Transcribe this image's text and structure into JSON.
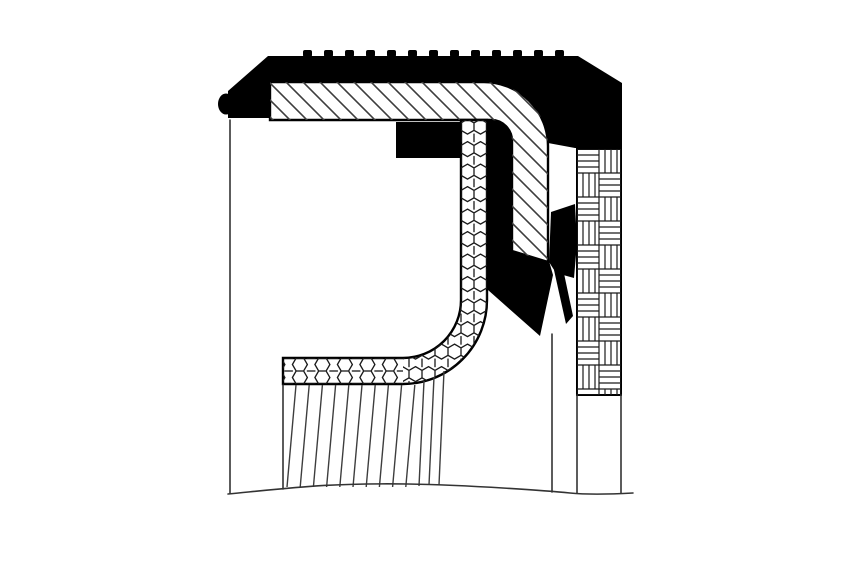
{
  "diagram": {
    "title": "Radial shaft seal cross-section diagram",
    "type": "technical line drawing",
    "parts": [
      {
        "name": "outer-case-cap",
        "rendering": "solid black, serrated top edge, beveled corners"
      },
      {
        "name": "metal-insert-band",
        "rendering": "diagonal line hatching, L-shaped band"
      },
      {
        "name": "spring-cavity-band",
        "rendering": "honeycomb hatching, J-shaped band"
      },
      {
        "name": "elastomer-lip",
        "rendering": "solid black with two downward lip points"
      },
      {
        "name": "press-fit-surface-column",
        "rendering": "basket-weave hatching"
      },
      {
        "name": "seal-body",
        "rendering": "white with thin contour outline"
      },
      {
        "name": "lip-contact-fan",
        "rendering": "fanned near-vertical hatching"
      },
      {
        "name": "shaft-break-line",
        "rendering": "wavy bottom cut line"
      }
    ]
  },
  "colors": {
    "background": "#ffffff",
    "ink": "#000000",
    "hatch": "#3d3d3d",
    "outline": "#333333",
    "fine": "#1a1a1a"
  },
  "serration": {
    "count": 13,
    "start_x": 303,
    "spacing": 21,
    "tooth_width": 9,
    "tooth_height": 7,
    "top_y": 50
  },
  "fan": {
    "count": 10,
    "start_x": 296,
    "spacing": 13.2,
    "lean": 9,
    "top_y": 385,
    "bottom_y": 487,
    "extra_lines": [
      [
        424,
        381,
        419,
        486
      ],
      [
        434,
        377,
        429,
        485
      ],
      [
        444,
        371,
        439,
        485
      ]
    ]
  }
}
